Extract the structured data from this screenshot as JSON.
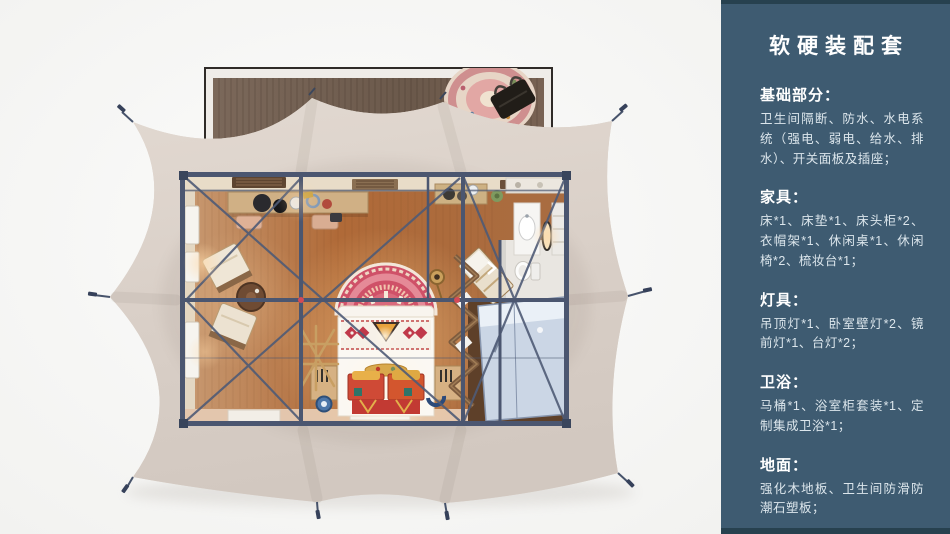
{
  "sidebar": {
    "title": "软硬装配套",
    "sections": [
      {
        "heading": "基础部分：",
        "body": "卫生间隔断、防水、水电系统（强电、弱电、给水、排水）、开关面板及插座；"
      },
      {
        "heading": "家具：",
        "body": "床*1、床垫*1、床头柜*2、衣帽架*1、休闲桌*1、休闲椅*2、梳妆台*1；"
      },
      {
        "heading": "灯具：",
        "body": "吊顶灯*1、卧室壁灯*2、镜前灯*1、台灯*2；"
      },
      {
        "heading": "卫浴：",
        "body": "马桶*1、浴室柜套装*1、定制集成卫浴*1；"
      },
      {
        "heading": "地面：",
        "body": "强化木地板、卫生间防滑防潮石塑板；"
      }
    ]
  },
  "floorplan": {
    "type": "illustration",
    "alt": "顶视图：帐篷客房布置（木平台、帐篷顶布、钢架、卧床、休闲椅、梳妆台、卫浴与淋浴房）"
  },
  "colors": {
    "sidebar_bg": "#3e5b71",
    "sidebar_edge": "#27414f",
    "sidebar_title": "#ffffff",
    "sidebar_text": "#dce6ec",
    "plan_bg": "#f7f7f5",
    "tent_canvas": "#dcd2c9",
    "deck_wood": "#6f5d4e",
    "frame_steel": "#4b5670",
    "floor_wood_warm": "#b06a38",
    "bed_accent": "#cf5168",
    "shower_glass": "#ccd7e6"
  }
}
